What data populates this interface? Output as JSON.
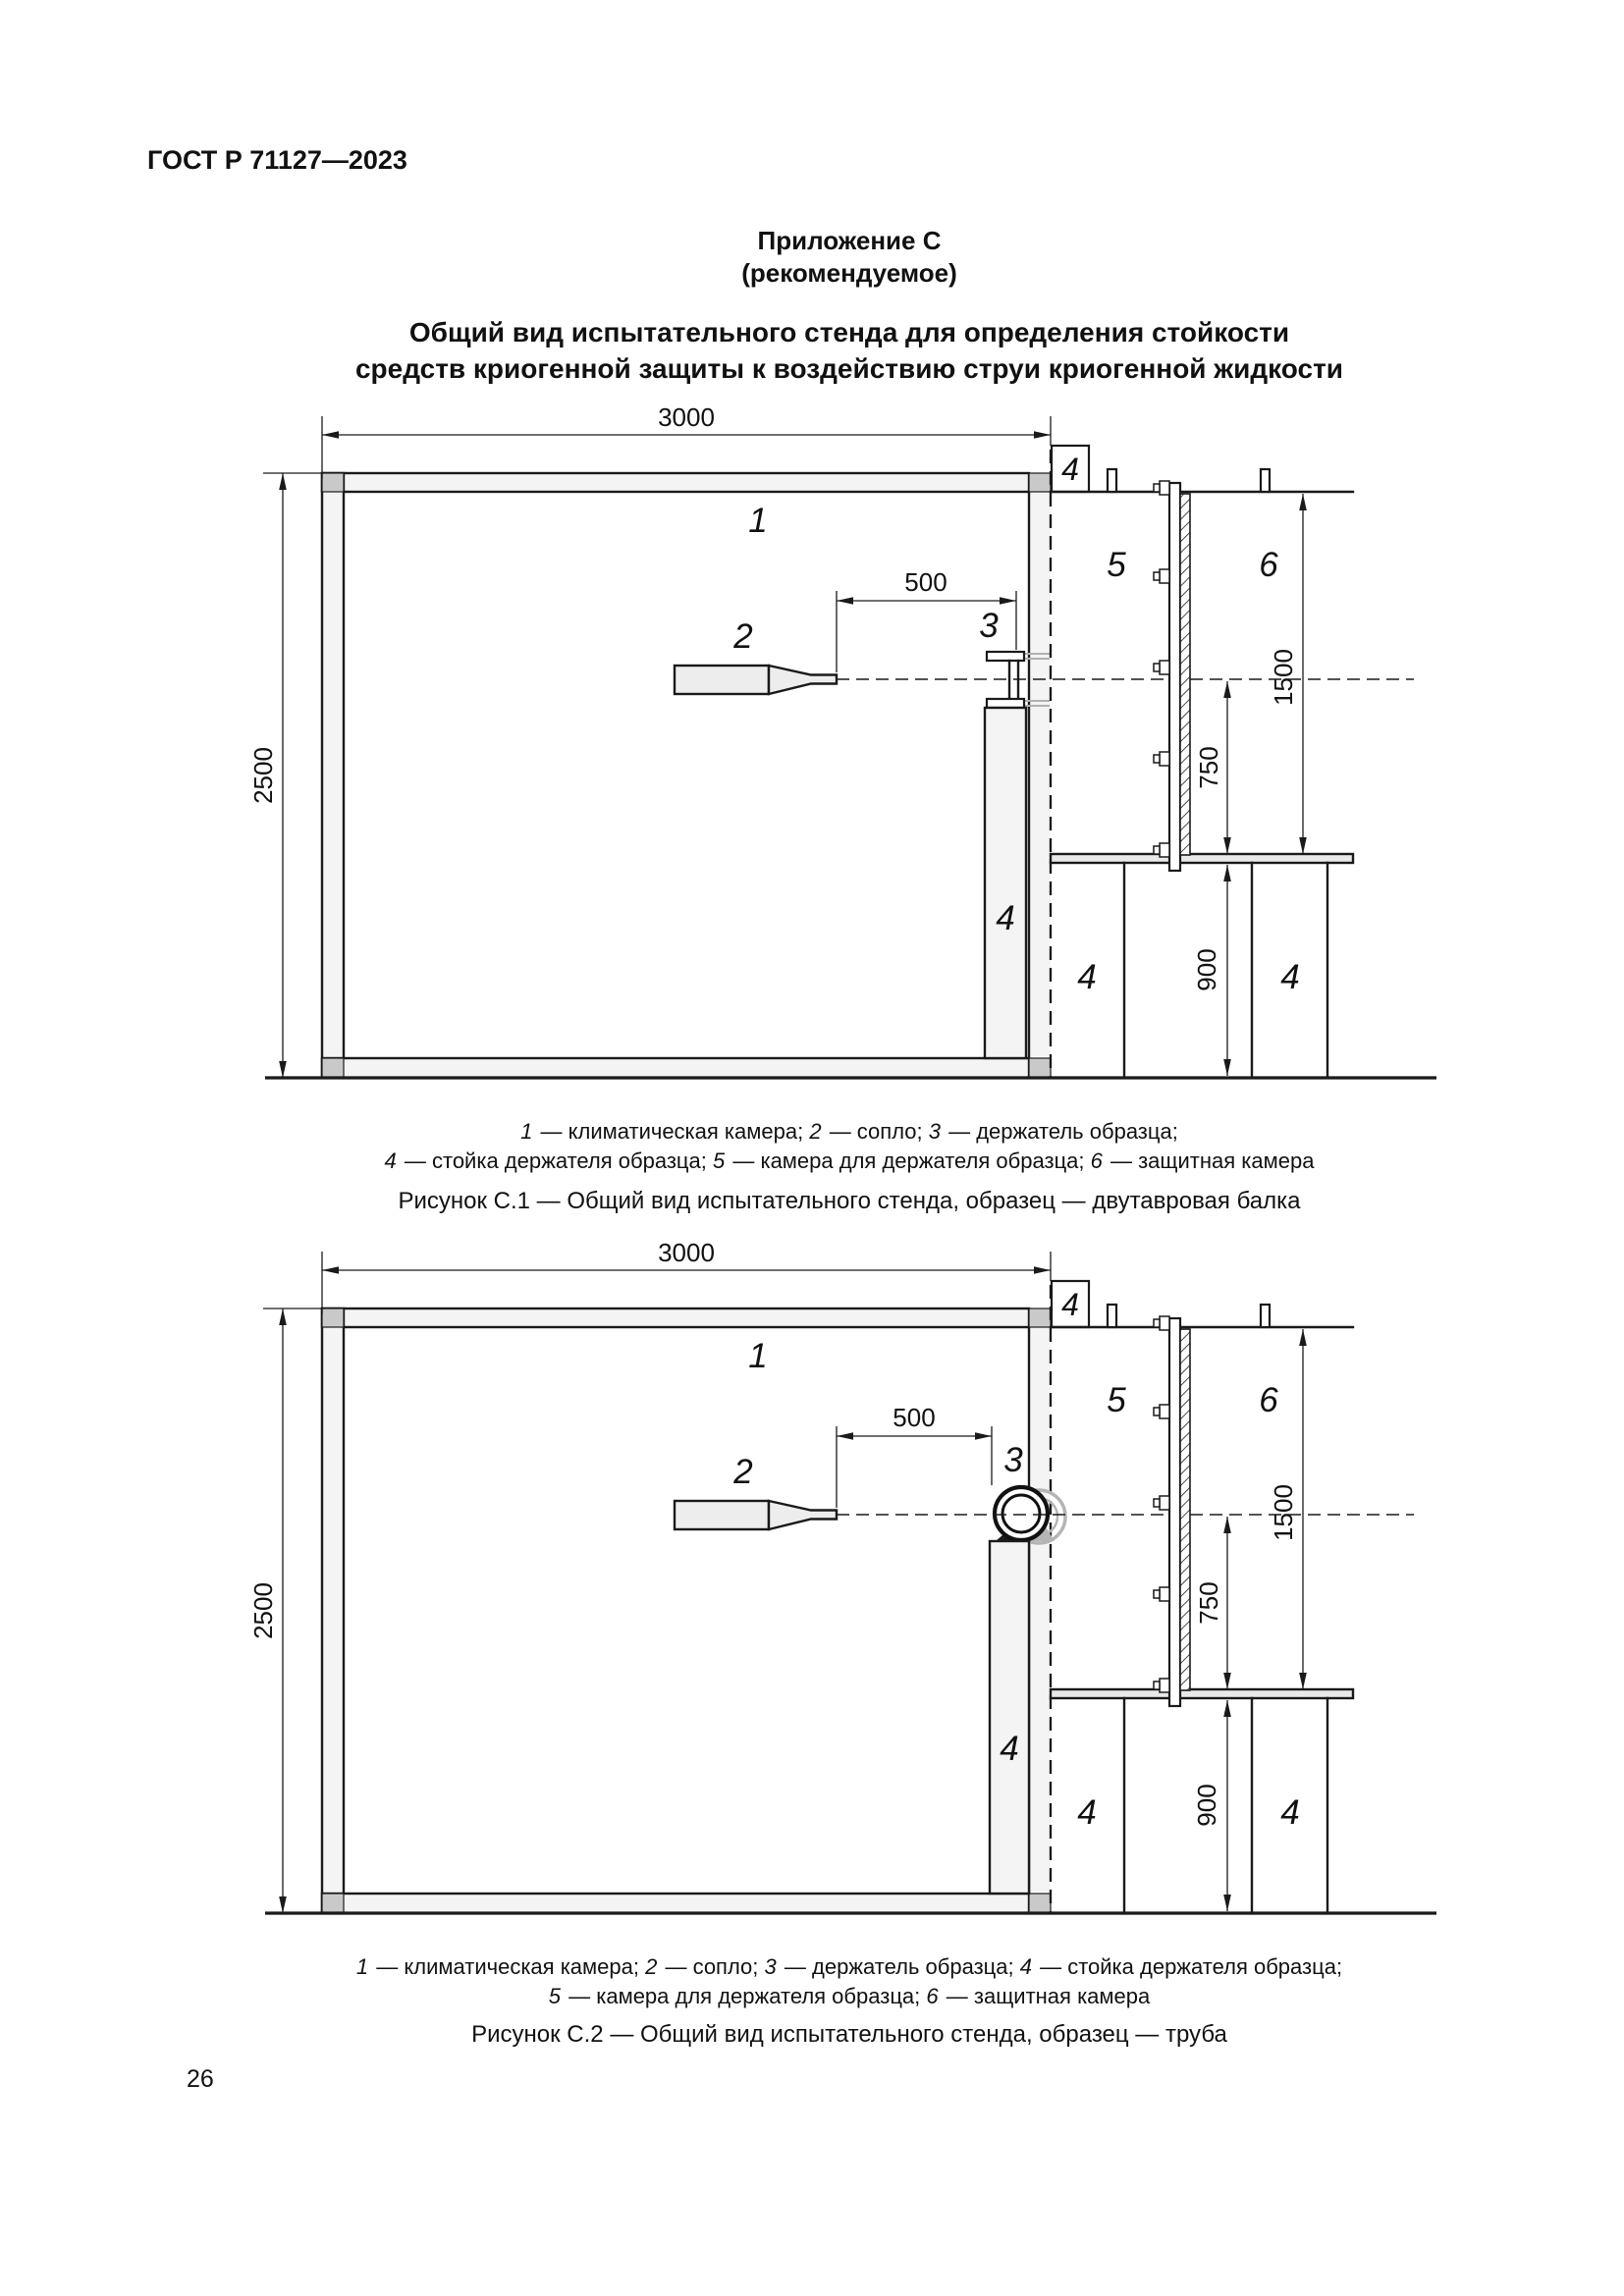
{
  "page": {
    "doc_code": "ГОСТ Р 71127—2023",
    "page_number": "26",
    "appendix": "Приложение С",
    "appendix_note": "(рекомендуемое)",
    "title_line1": "Общий вид испытательного стенда для определения стойкости",
    "title_line2": "средств криогенной защиты к воздействию струи криогенной жидкости"
  },
  "labels": {
    "climatic_chamber": "1",
    "nozzle": "2",
    "specimen_holder": "3",
    "holder_stand": "4",
    "holder_chamber": "5",
    "protective_chamber": "6"
  },
  "dimensions": {
    "chamber_width": "3000",
    "chamber_height": "2500",
    "nozzle_to_specimen": "500",
    "panel_height": "1500",
    "axis_to_shelf": "750",
    "table_height": "900"
  },
  "fig1": {
    "legend_line1": [
      {
        "num": "1",
        "text": " — климатическая камера; "
      },
      {
        "num": "2",
        "text": " — сопло; "
      },
      {
        "num": "3",
        "text": " — держатель образца;"
      }
    ],
    "legend_line2": [
      {
        "num": "4",
        "text": " — стойка держателя образца; "
      },
      {
        "num": "5",
        "text": " — камера для держателя образца; "
      },
      {
        "num": "6",
        "text": " — защитная камера"
      }
    ],
    "caption": "Рисунок С.1 — Общий вид испытательного стенда, образец — двутавровая балка"
  },
  "fig2": {
    "legend_line1": [
      {
        "num": "1",
        "text": " — климатическая камера; "
      },
      {
        "num": "2",
        "text": " — сопло; "
      },
      {
        "num": "3",
        "text": " — держатель образца; "
      },
      {
        "num": "4",
        "text": " — стойка держателя образца;"
      }
    ],
    "legend_line2": [
      {
        "num": "5",
        "text": " — камера для держателя образца; "
      },
      {
        "num": "6",
        "text": " — защитная камера"
      }
    ],
    "caption": "Рисунок С.2 — Общий вид испытательного стенда, образец — труба"
  }
}
